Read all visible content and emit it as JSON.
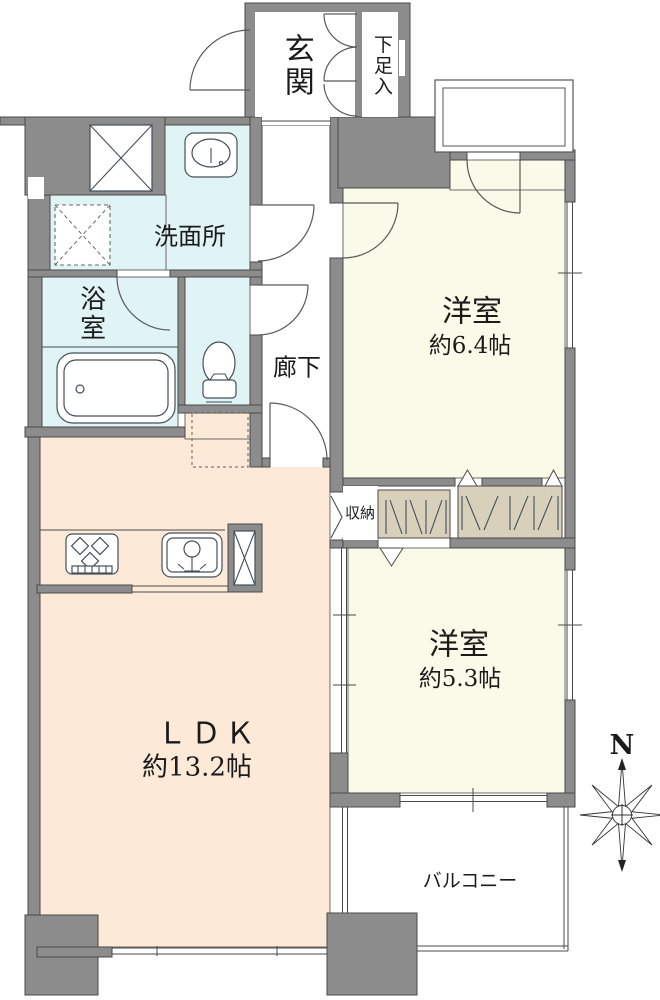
{
  "floorplan": {
    "rooms": {
      "genkan": {
        "label": "玄関"
      },
      "shoe_cabinet": {
        "label": "下足入"
      },
      "washroom": {
        "label": "洗面所"
      },
      "bathroom": {
        "label": "浴室"
      },
      "hallway": {
        "label": "廊下"
      },
      "bedroom1": {
        "label": "洋室",
        "size": "約6.4帖"
      },
      "storage": {
        "label": "収納"
      },
      "bedroom2": {
        "label": "洋室",
        "size": "約5.3帖"
      },
      "ldk": {
        "label": "ＬＤＫ",
        "size": "約13.2帖"
      },
      "balcony": {
        "label": "バルコニー"
      }
    },
    "compass": {
      "label": "N"
    },
    "colors": {
      "wall": "#8c8c8c",
      "bedroom_cream": "#fafae9",
      "ldk_peach": "#fce9d8",
      "wet_area_cyan": "#e0f3f5",
      "closet_tan": "#d9d0bb",
      "outline": "#4a4a4a"
    }
  }
}
